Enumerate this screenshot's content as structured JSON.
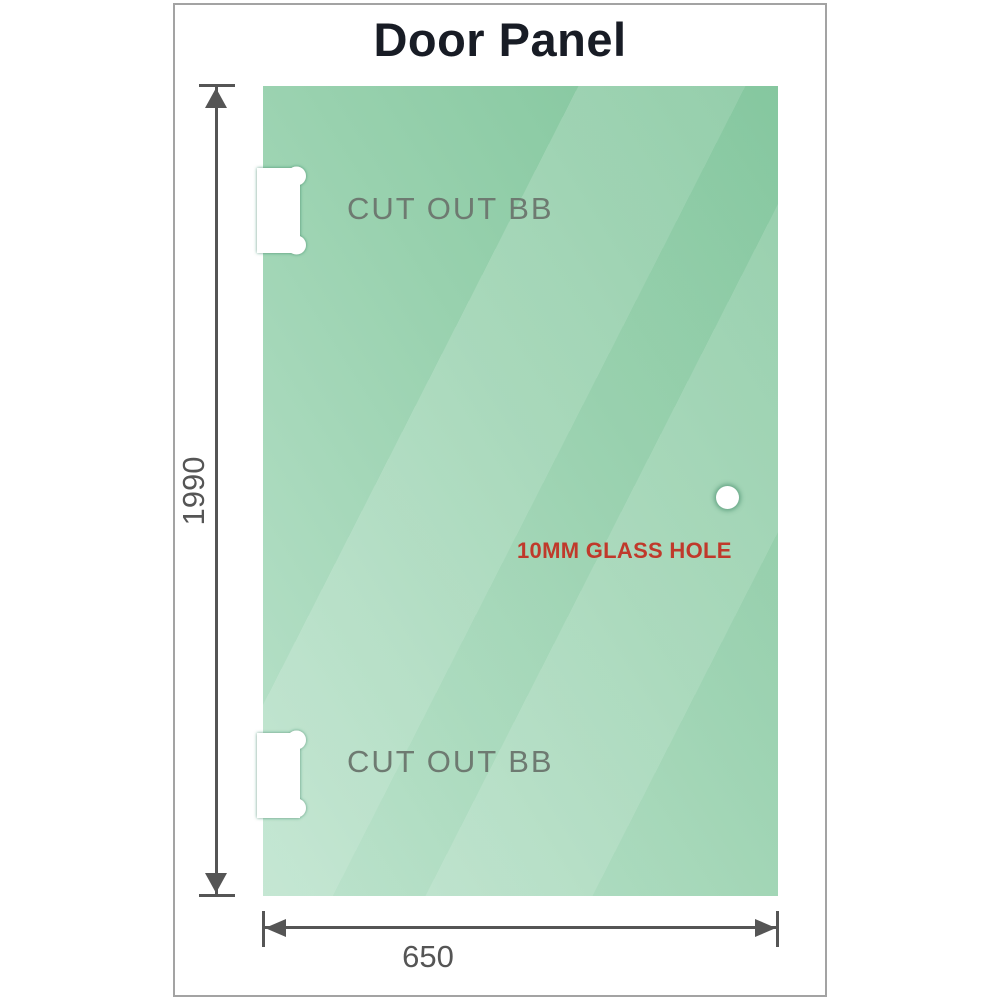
{
  "title": "Door Panel",
  "panel": {
    "top_cutout": {
      "label": "CUT OUT BB"
    },
    "bottom_cutout": {
      "label": "CUT OUT BB"
    },
    "glass_hole": {
      "label": "10MM GLASS HOLE"
    }
  },
  "dimensions": {
    "height": {
      "value": "1990"
    },
    "width": {
      "value": "650"
    }
  },
  "colors": {
    "glass-dark": "#7fc49a",
    "glass-mid": "#98d1ae",
    "glass-light": "#bae2cb",
    "dimension-line": "#555555",
    "cutout-label": "#6e7a71",
    "hole-label": "#c0392b",
    "title-color": "#181c25",
    "frame-border": "#a3a3a3"
  }
}
